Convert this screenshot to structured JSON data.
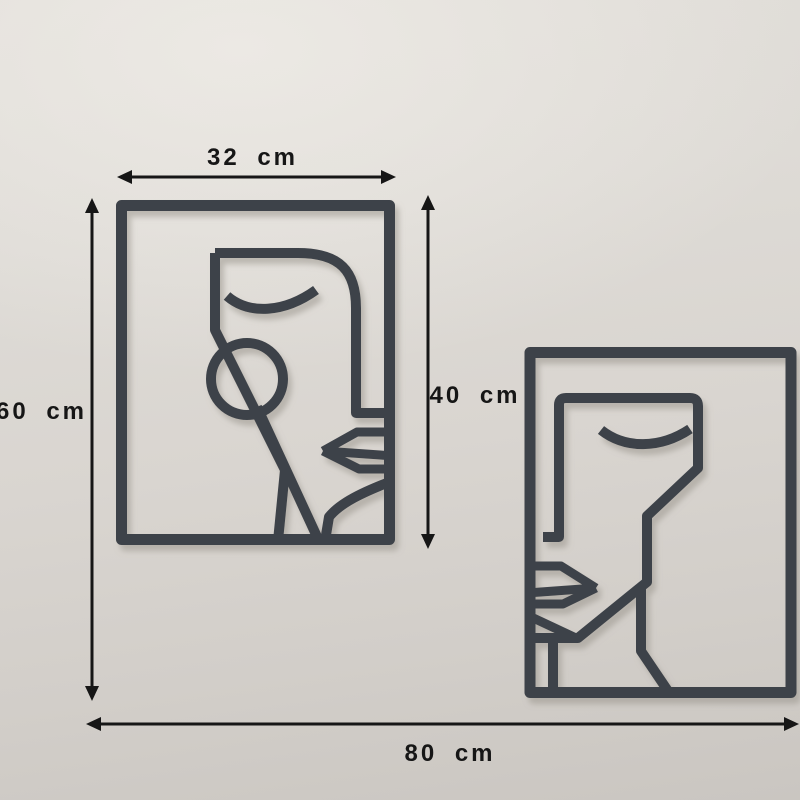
{
  "scene": {
    "title": "Two abstract line-art face wall panels with dimension annotations"
  },
  "dimensions": {
    "panel_width": "32 cm",
    "total_height": "60 cm",
    "panel_height": "40 cm",
    "total_width": "80 cm"
  },
  "colors": {
    "wall_light": "#e1ded9",
    "wall_dark": "#cac6c1",
    "artwork_metal": "#3e434a",
    "dimension_lines": "#161616"
  }
}
